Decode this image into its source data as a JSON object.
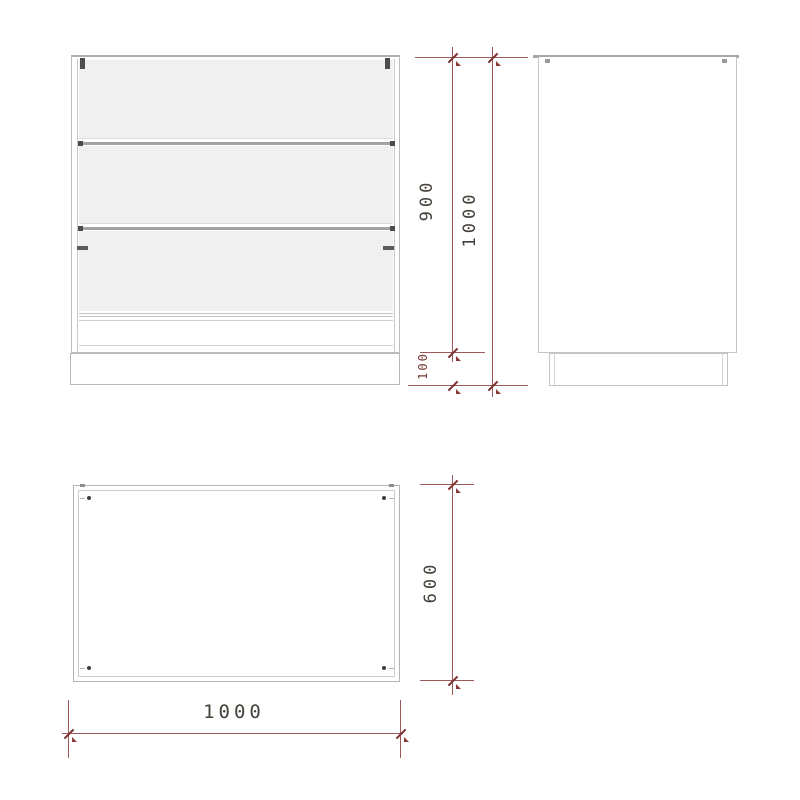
{
  "drawing": {
    "type": "furniture-technical-drawing",
    "dimensions": {
      "body_height": "900",
      "total_height": "1000",
      "plinth_height": "100",
      "depth": "600",
      "width": "1000"
    },
    "colors": {
      "dimension_line": "#9d5a5a",
      "dimension_tick": "#7c2f2f",
      "dimension_text": "#45403a",
      "dimension_text_small": "#733831",
      "outline": "#c4c4c4",
      "outline_dark": "#a8a8a8",
      "panel_fill": "#f0f0f1",
      "hardware": "#4c4c4c",
      "background": "#ffffff"
    }
  }
}
